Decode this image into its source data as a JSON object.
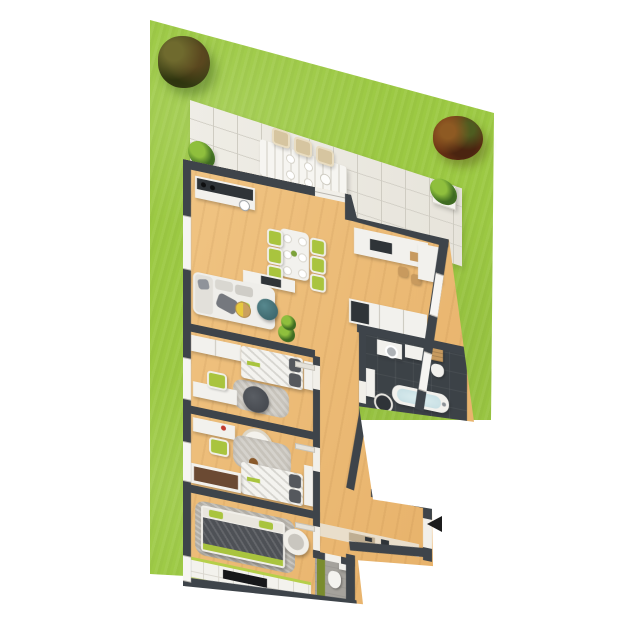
{
  "scene": {
    "type": "3d-floor-plan-render",
    "title": "Apartment floor plan with garden",
    "background_color": "#ffffff"
  },
  "palette": {
    "lawn_green": "#9cc943",
    "wall_dark": "#3e444a",
    "wood_floor": "#ecbf7d",
    "terrace_tile": "#ece9e1",
    "furniture_white": "#f2f1ed",
    "accent_green": "#a9c43e",
    "accent_teal": "#3f6e74",
    "bath_floor_dark": "#3c4247",
    "arrow_black": "#1c1c1c"
  },
  "garden": {
    "name": "lawn",
    "trees": [
      {
        "name": "dark-green-tree",
        "position": "top-left"
      },
      {
        "name": "red-brown-tree",
        "position": "right"
      }
    ]
  },
  "terrace": {
    "name": "tiled-terrace",
    "furniture": [
      "outdoor-dining-table",
      "six-outdoor-chairs",
      "potted-plant-left",
      "potted-plant-right"
    ],
    "chairs_count": 6
  },
  "apartment": {
    "rooms": [
      {
        "name": "living-room-kitchen",
        "floor": "wood",
        "furniture": [
          "kitchen-counter-with-sink-and-hob",
          "kitchen-island-with-cooktop",
          "two-bar-stools",
          "tall-kitchen-cabinet",
          "dining-table-six-green-chairs",
          "sofa-with-pillows",
          "teal-armchair",
          "round-wood-coffee-table",
          "tv-sideboard",
          "potted-plant"
        ]
      },
      {
        "name": "hallway",
        "floor": "wood",
        "furniture": [
          "built-in-closet",
          "doormat-with-shoes"
        ]
      },
      {
        "name": "bathroom",
        "floor": "dark-tile",
        "furniture": [
          "washing-machine",
          "white-cabinet",
          "wooden-crates",
          "toilet",
          "bathtub",
          "round-stool",
          "side-cabinet"
        ]
      },
      {
        "name": "bedroom-1",
        "floor": "wood",
        "furniture": [
          "double-bed-dark-pillows",
          "wardrobe",
          "desk",
          "green-chair",
          "gray-rug",
          "dark-pouf",
          "bedside-shelf"
        ]
      },
      {
        "name": "bedroom-2",
        "floor": "wood",
        "furniture": [
          "bed-dark-pillows",
          "desk-with-red-lamp",
          "green-chair",
          "hanging-chair",
          "gray-rug",
          "teddy-bear",
          "shelf-unit",
          "bench-with-brown-cushion"
        ]
      },
      {
        "name": "master-bedroom",
        "floor": "wood",
        "furniture": [
          "double-bed-dark-blanket-green-trim",
          "gray-area-rug",
          "papasan-chair",
          "white-tile-strip-with-green-stripes",
          "black-mat"
        ]
      },
      {
        "name": "wc",
        "floor": "gray-tile",
        "furniture": [
          "toilet",
          "green-wall-panel",
          "small-sink"
        ]
      }
    ],
    "entrance": {
      "marker": "entrance-arrow",
      "direction": "left",
      "color": "#1c1c1c"
    }
  }
}
